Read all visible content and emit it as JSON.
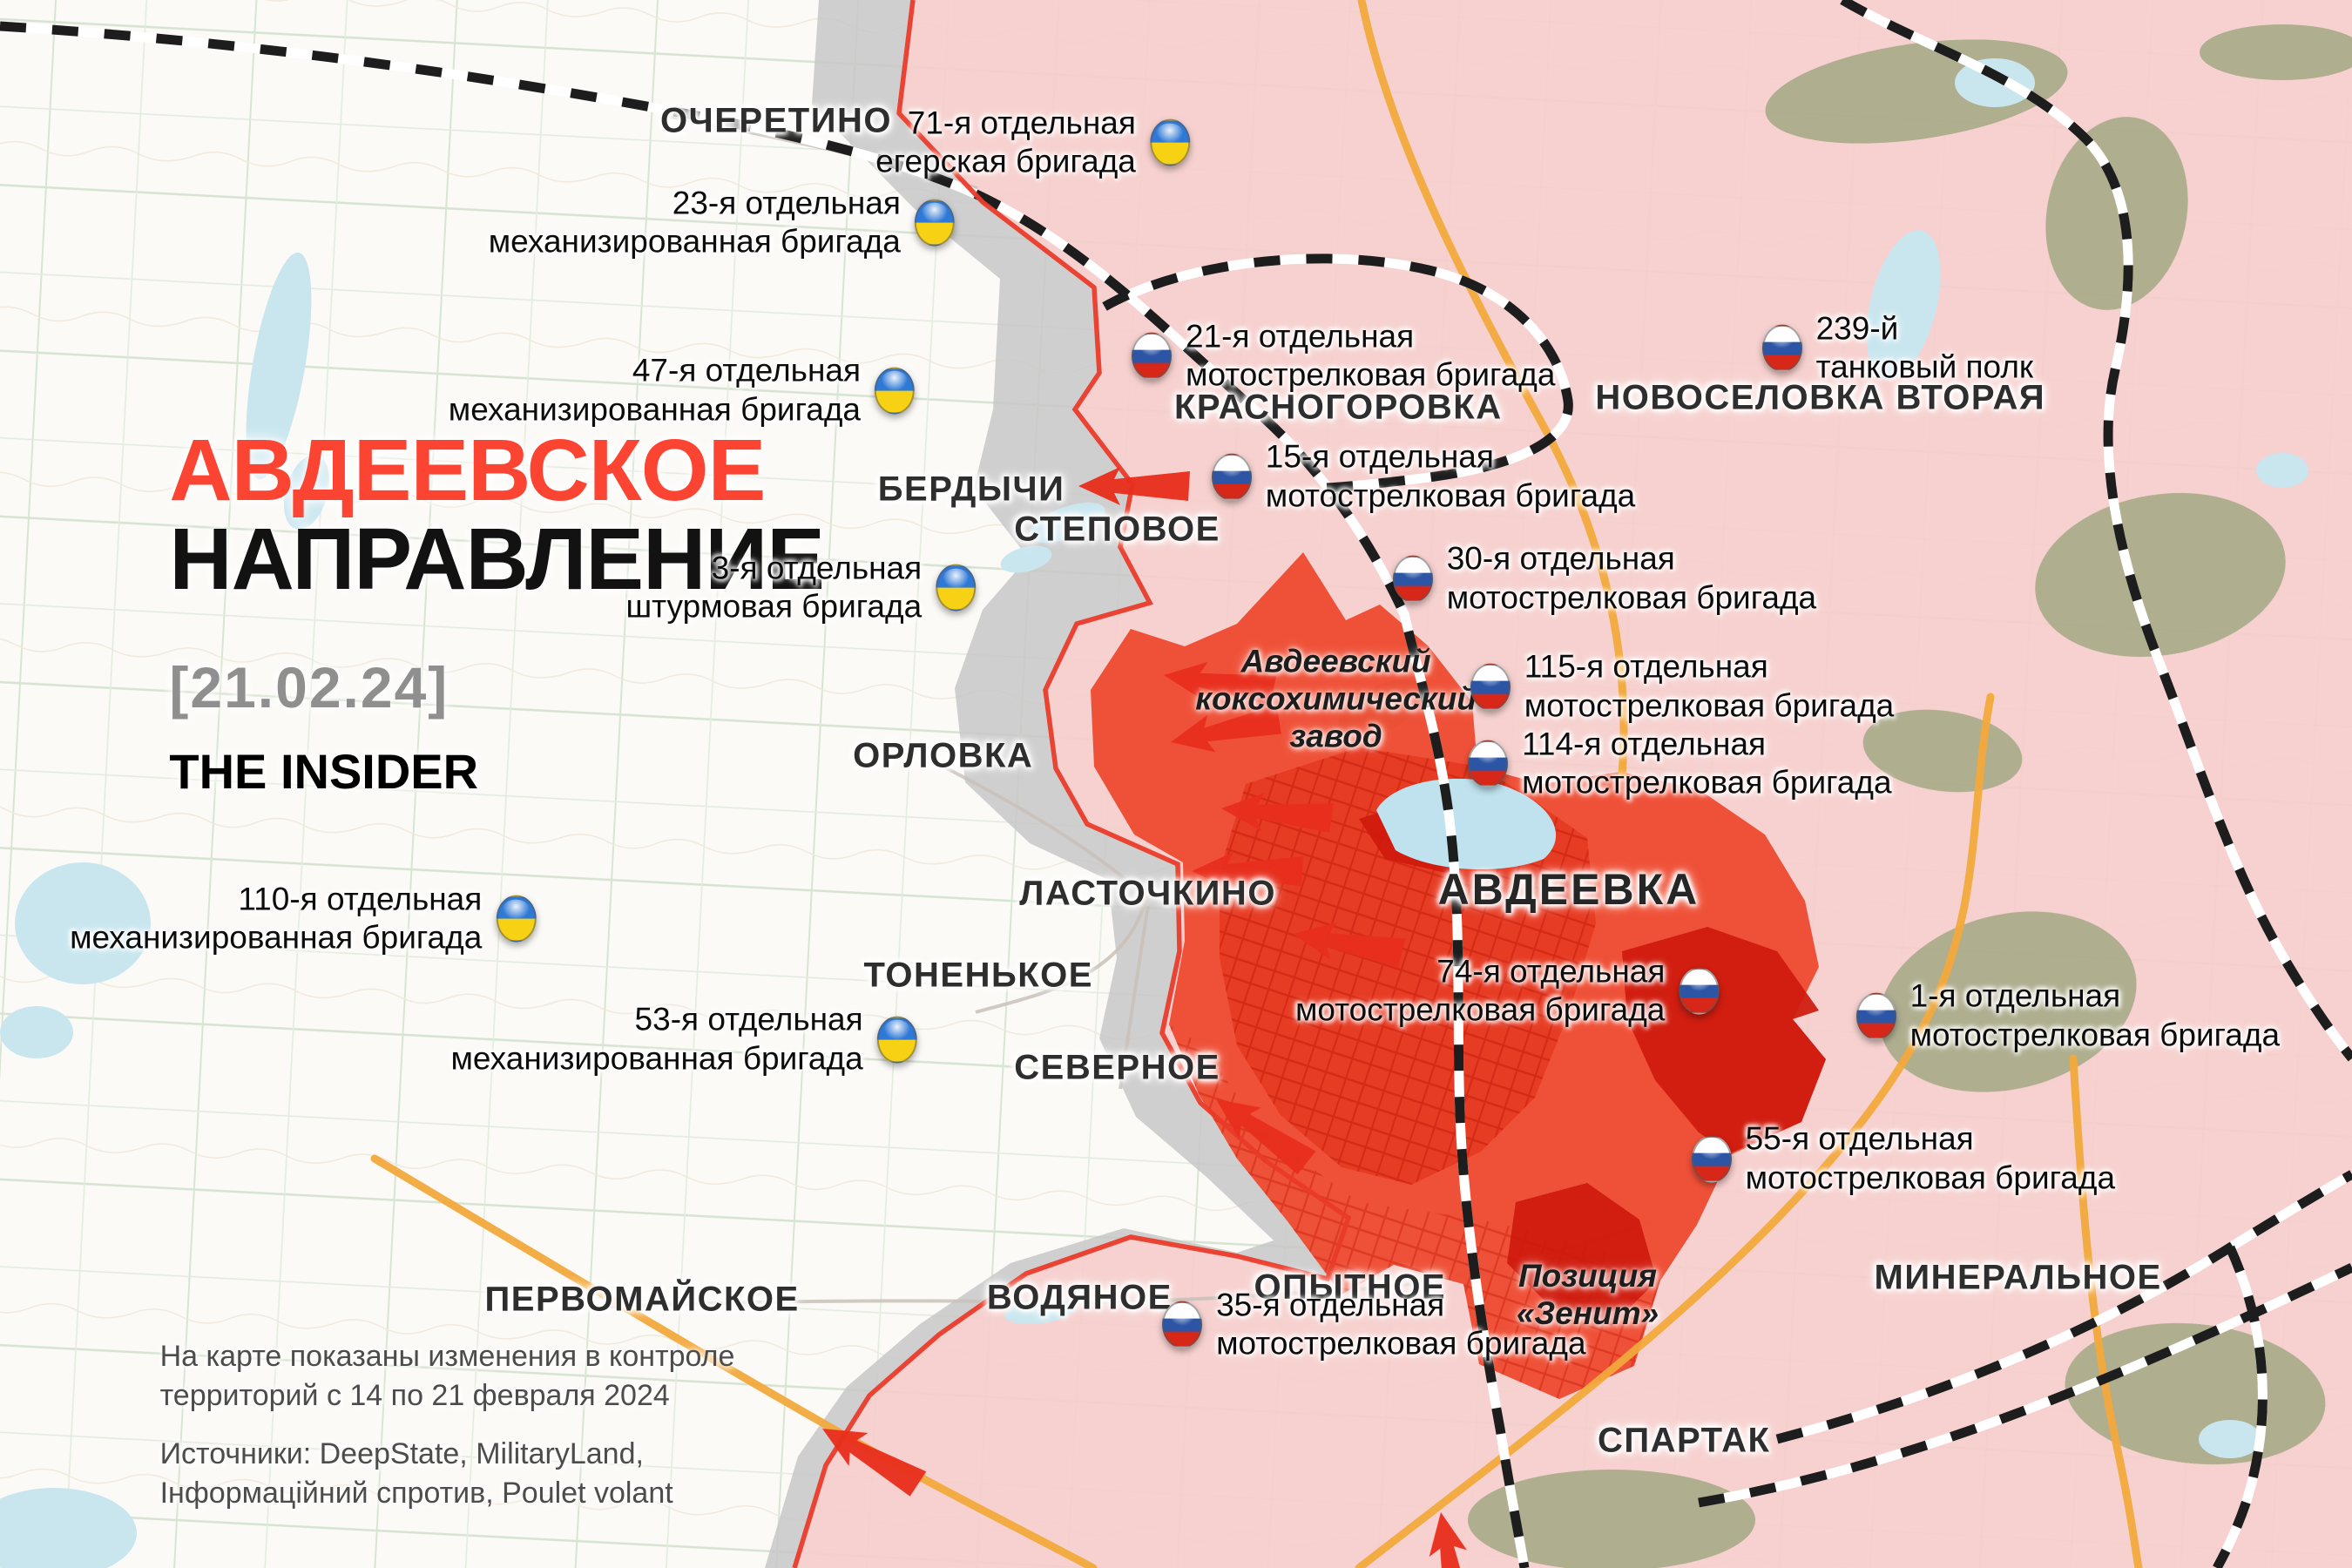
{
  "header": {
    "title_red": "АВДЕЕВСКОЕ",
    "title_black": "НАПРАВЛЕНИЕ",
    "date": "[21.02.24]",
    "brand": "THE INSIDER"
  },
  "footer": {
    "note_line1": "На карте показаны изменения в контроле",
    "note_line2": "территорий с 14 по 21 февраля 2024",
    "sources_line1": "Источники: DeepState, MilitaryLand,",
    "sources_line2": "Інформаційний спротив, Poulet volant"
  },
  "cities": {
    "ocheretino": "ОЧЕРЕТИНО",
    "berdychi": "БЕРДЫЧИ",
    "stepovoe": "СТЕПОВОЕ",
    "orlovka": "ОРЛОВКА",
    "lastochkino": "ЛАСТОЧКИНО",
    "tonenkoe": "ТОНЕНЬКОЕ",
    "severnoe": "СЕВЕРНОЕ",
    "pervomayskoe": "ПЕРВОМАЙСКОЕ",
    "vodyanoe": "ВОДЯНОЕ",
    "opytnoe": "ОПЫТНОЕ",
    "spartak": "СПАРТАК",
    "mineralnoe": "МИНЕРАЛЬНОЕ",
    "krasnogorovka": "КРАСНОГОРОВКА",
    "novoselovka": "НОВОСЕЛОВКА ВТОРАЯ",
    "avdeevka": "АВДЕЕВКА"
  },
  "landmarks": {
    "plant": {
      "line1": "Авдеевский",
      "line2": "коксохимический",
      "line3": "завод"
    },
    "zenit": {
      "line1": "Позиция",
      "line2": "«Зенит»"
    }
  },
  "units": {
    "ua71": {
      "line1": "71-я отдельная",
      "line2": "егерская бригада"
    },
    "ua23": {
      "line1": "23-я отдельная",
      "line2": "механизированная бригада"
    },
    "ua47": {
      "line1": "47-я отдельная",
      "line2": "механизированная бригада"
    },
    "ua3": {
      "line1": "3-я отдельная",
      "line2": "штурмовая бригада"
    },
    "ua110": {
      "line1": "110-я отдельная",
      "line2": "механизированная бригада"
    },
    "ua53": {
      "line1": "53-я отдельная",
      "line2": "механизированная бригада"
    },
    "ru21": {
      "line1": "21-я отдельная",
      "line2": "мотострелковая бригада"
    },
    "ru15": {
      "line1": "15-я отдельная",
      "line2": "мотострелковая бригада"
    },
    "ru30": {
      "line1": "30-я отдельная",
      "line2": "мотострелковая бригада"
    },
    "ru115": {
      "line1": "115-я отдельная",
      "line2": "мотострелковая бригада"
    },
    "ru114": {
      "line1": "114-я отдельная",
      "line2": "мотострелковая бригада"
    },
    "ru239": {
      "line1": "239-й",
      "line2": "танковый полк"
    },
    "ru74": {
      "line1": "74-я отдельная",
      "line2": "мотострелковая бригада"
    },
    "ru1": {
      "line1": "1-я отдельная",
      "line2": "мотострелковая бригада"
    },
    "ru55": {
      "line1": "55-я отдельная",
      "line2": "мотострелковая бригада"
    },
    "ru35": {
      "line1": "35-я отдельная",
      "line2": "мотострелковая бригада"
    }
  },
  "colors": {
    "title_red": "#fc4433",
    "occupied_pink": "#f5cecb",
    "advance_red": "#ee4a2f",
    "captured_dark_red": "#cf1a0d",
    "contested_gray": "#c6c6c6",
    "frontline_red": "#ea3b2a",
    "ua_flag_blue": "#2f79d6",
    "ua_flag_yellow": "#f7d214",
    "ru_flag_blue": "#2d55a5",
    "ru_flag_red": "#d62718"
  }
}
